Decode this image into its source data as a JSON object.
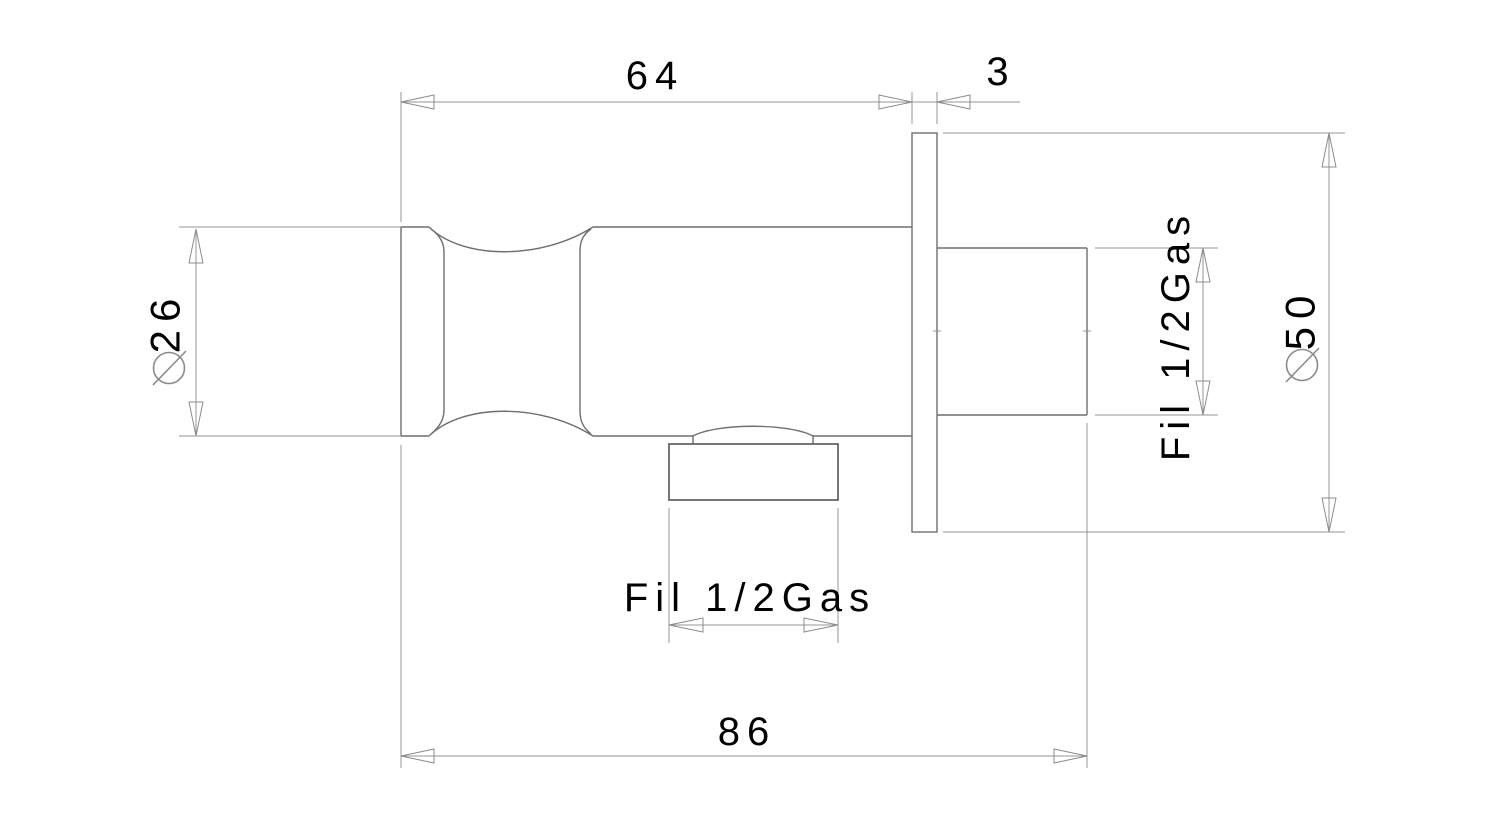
{
  "drawing": {
    "title": "wall-mounted valve elbow dimension drawing",
    "units": "mm",
    "background_color": "#ffffff",
    "outline_color": "#6f6f6f",
    "dimension_line_color": "#949494",
    "text_color": "#000000",
    "dimensions": {
      "body_length": {
        "label": "64"
      },
      "plate_thickness": {
        "label": "3"
      },
      "body_diameter": {
        "symbol": "∅",
        "value": "26"
      },
      "plate_diameter": {
        "symbol": "∅",
        "value": "50"
      },
      "overall_length": {
        "label": "86"
      },
      "outlet_thread": {
        "label": "Fil 1/2Gas"
      },
      "inlet_thread": {
        "label": "Fil 1/2Gas"
      }
    }
  }
}
